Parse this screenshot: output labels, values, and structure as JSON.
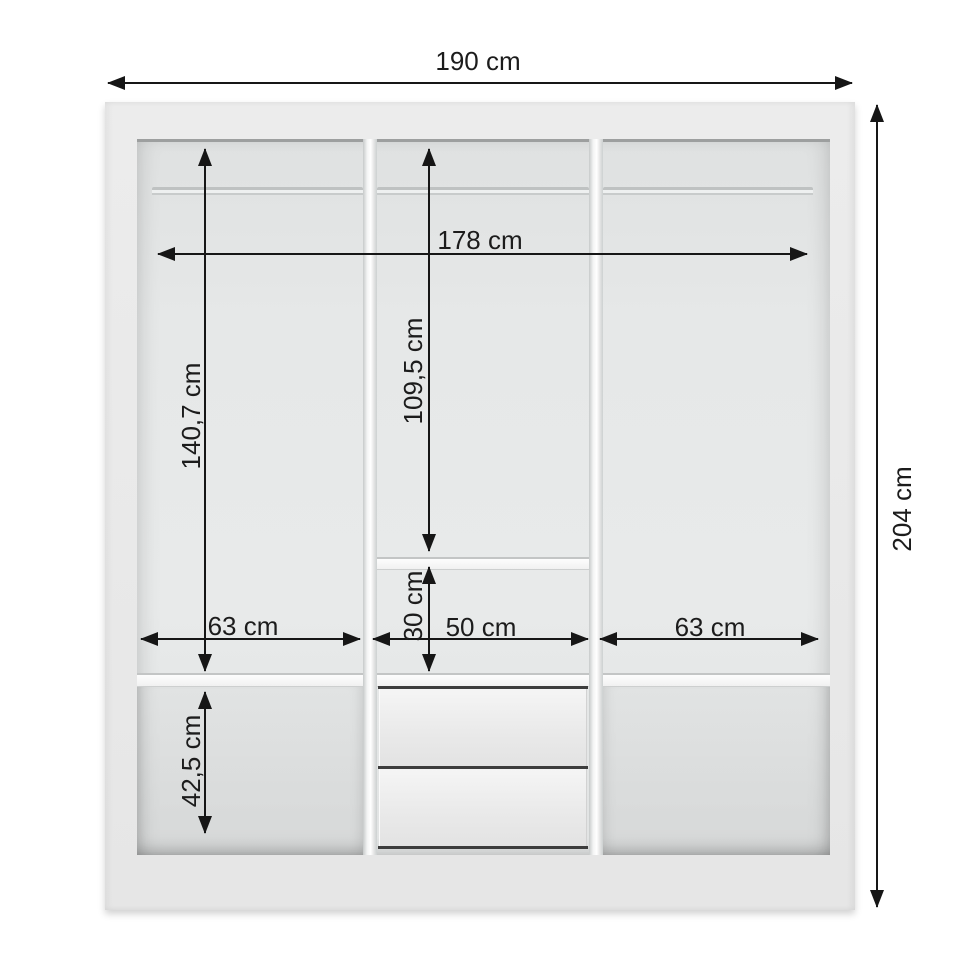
{
  "diagram": {
    "dimensions": {
      "overall_width": "190 cm",
      "overall_height": "204 cm",
      "interior_width": "178 cm",
      "left_section_height": "140,7 cm",
      "center_section_height": "109,5 cm",
      "center_shelf_gap_height": "30 cm",
      "left_section_width": "63 cm",
      "center_section_width": "50 cm",
      "right_section_width": "63 cm",
      "bottom_section_height": "42,5 cm"
    },
    "structure": {
      "sections": 3,
      "drawers": 2,
      "hanging_rods": 3
    },
    "colors": {
      "background": "#ffffff",
      "cabinet_body": "#e9e9e9",
      "cabinet_interior": "#e6e8e8",
      "dimension_line": "#161616",
      "drawer_gap_line": "#3d3d3d"
    }
  }
}
